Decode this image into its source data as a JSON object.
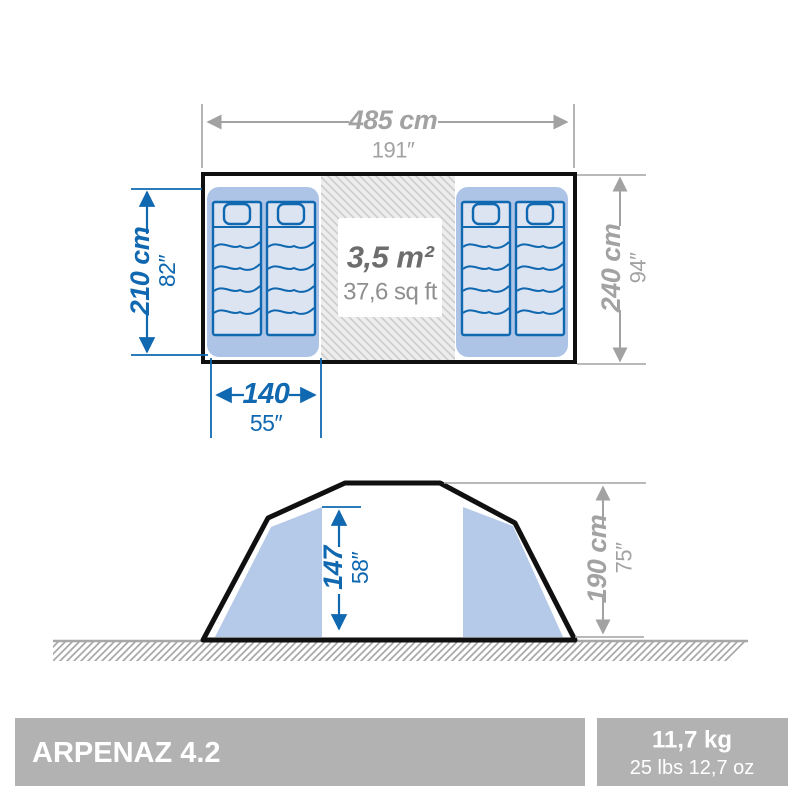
{
  "colors": {
    "dim_blue": "#1068b0",
    "dim_gray": "#a2a2a2",
    "text_dark": "#6d6d6d",
    "text_mid": "#8f8f8f",
    "line_black": "#101010",
    "compartment_blue": "#aec4e6",
    "panel_blue": "#b5c9e8",
    "mattress_fill": "#dce4f2",
    "hatch_bg": "#ededed",
    "hatch_line": "#cccccc",
    "ground_gray": "#a8a8a8",
    "bar_gray": "#b2b2b2"
  },
  "floor_plan": {
    "width_dim": {
      "cm": "485 cm",
      "inch": "191″"
    },
    "depth_dim": {
      "cm": "240 cm",
      "inch": "94″"
    },
    "bedroom_depth_dim": {
      "cm": "210 cm",
      "inch": "82″"
    },
    "bed_width_dim": {
      "cm": "140",
      "inch": "55″"
    },
    "living_area": {
      "metric": "3,5 m²",
      "imperial": "37,6 sq ft"
    }
  },
  "side_view": {
    "interior_height_dim": {
      "cm": "147",
      "inch": "58″"
    },
    "exterior_height_dim": {
      "cm": "190 cm",
      "inch": "75″"
    }
  },
  "footer": {
    "model": "ARPENAZ 4.2",
    "weight_kg": "11,7 kg",
    "weight_lbs": "25 lbs 12,7 oz"
  }
}
